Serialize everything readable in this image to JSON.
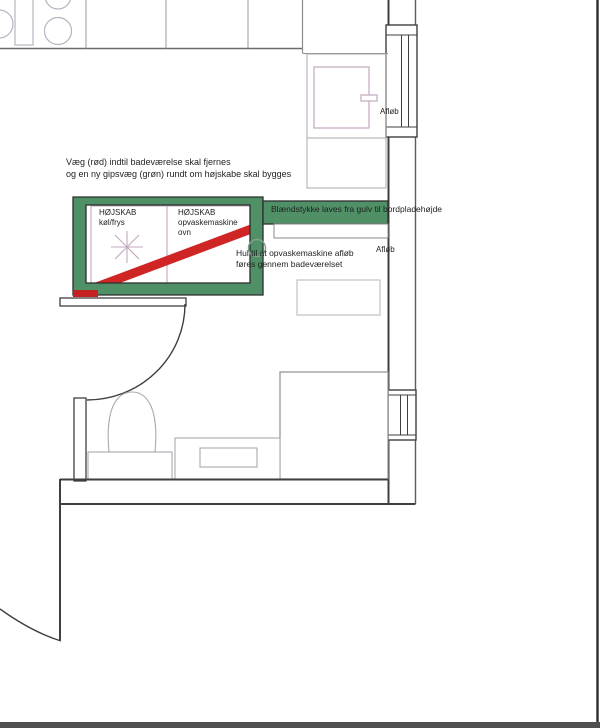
{
  "plan": {
    "notes": {
      "wall_note": {
        "line1": "Væg (rød) indtil badeværelse skal fjernes",
        "line2": "og en ny gipsvæg (grøn) rundt om højskabe skal bygges"
      },
      "blaendstykke_label": "Blændstykke laves fra gulv til bordpladehøjde",
      "hole_note": {
        "line1": "Hul til at opvaskemaskine afløb",
        "line2": "føres gennem badeværelset"
      }
    },
    "cabinets": {
      "tall_cabinet_fridge": {
        "line1": "HØJSKAB",
        "line2": "køl/frys"
      },
      "tall_cabinet_dishwasher": {
        "line1": "HØJSKAB",
        "line2": "opvaskemaskine",
        "line3": "ovn"
      }
    },
    "drains": {
      "top": "Afløb",
      "middle": "Afløb"
    },
    "colors": {
      "new_wall_green": "#4f9067",
      "remove_wall_red": "#d02525",
      "wall_line": "#3f3f3f",
      "fixture_line": "#a9a9b0",
      "cabinet_line": "#c2a8bd",
      "bottom_bar": "#4f4f4f"
    }
  }
}
